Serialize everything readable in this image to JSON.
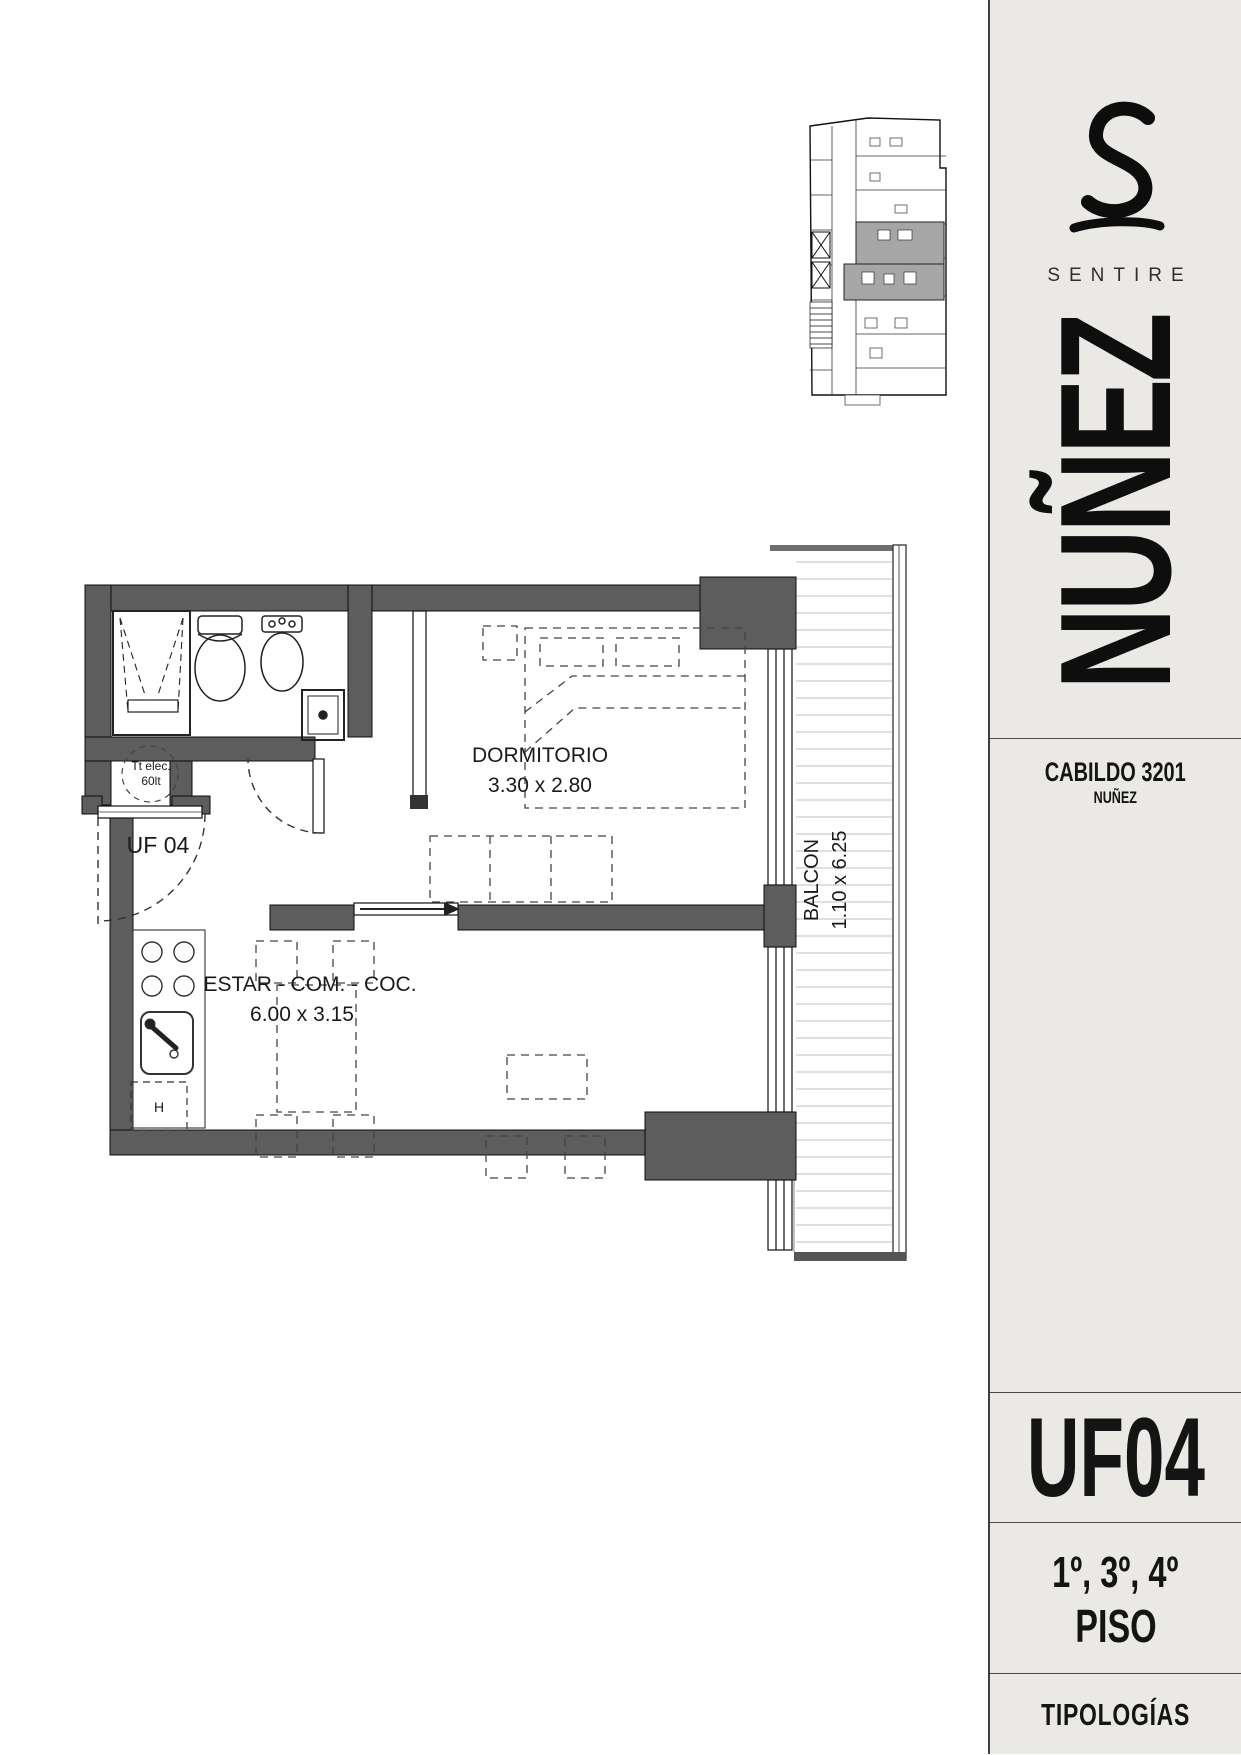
{
  "sidebar": {
    "bg": "#eae9e6",
    "accent": "#141414",
    "brand": {
      "logo_icon": "sentire-script-s-icon",
      "name": "SENTIRE"
    },
    "project_vertical": "NUÑEZ",
    "address_line1": "CABILDO 3201",
    "address_line2": "NUÑEZ",
    "unit_code": "UF04",
    "floors": "1º, 3º, 4º",
    "floors_label": "PISO",
    "footer_label": "TIPOLOGÍAS"
  },
  "plan": {
    "wall_color": "#5d5d5d",
    "rooms": [
      {
        "name": "DORMITORIO",
        "dimensions": "3.30 x 2.80"
      },
      {
        "name": "ESTAR - COM. - COC.",
        "dimensions": "6.00 x 3.15"
      },
      {
        "name": "BALCON",
        "dimensions": "1.10 x 6.25"
      }
    ],
    "unit_label": "UF 04",
    "equipment": {
      "water_heater_line1": "Tt elec.",
      "water_heater_line2": "60lt",
      "hood_label": "H"
    }
  },
  "key_plan": {
    "name": "building-key-plan",
    "highlight_color": "#a6a6a6"
  }
}
